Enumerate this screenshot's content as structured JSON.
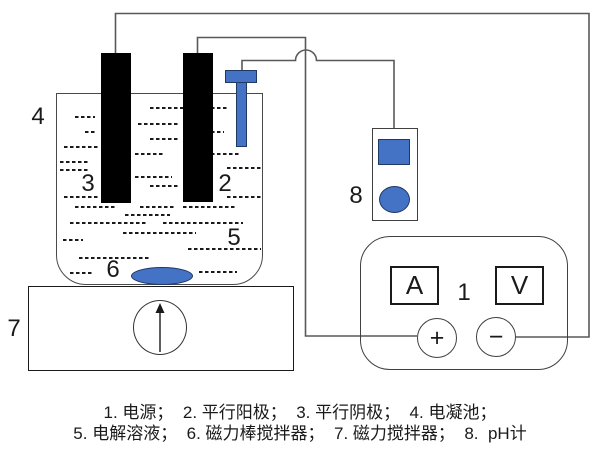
{
  "callouts": {
    "power_supply": "1",
    "anode": "2",
    "cathode": "3",
    "cell": "4",
    "electrolyte": "5",
    "stir_bar": "6",
    "stirrer": "7",
    "ph_meter": "8"
  },
  "power_supply": {
    "ammeter": "A",
    "voltmeter": "V",
    "positive": "+",
    "negative": "−"
  },
  "caption": {
    "line1": "1. 电源；  2. 平行阳极；  3. 平行阴极；  4. 电凝池；",
    "line2": "5. 电解溶液；  6. 磁力棒搅拌器；  7. 磁力搅拌器；  8.  pH计"
  },
  "colors": {
    "accent_blue": "#4472C4",
    "accent_blue_border": "#1F3864",
    "electrode_black": "#000000",
    "wire_gray": "#595959"
  }
}
